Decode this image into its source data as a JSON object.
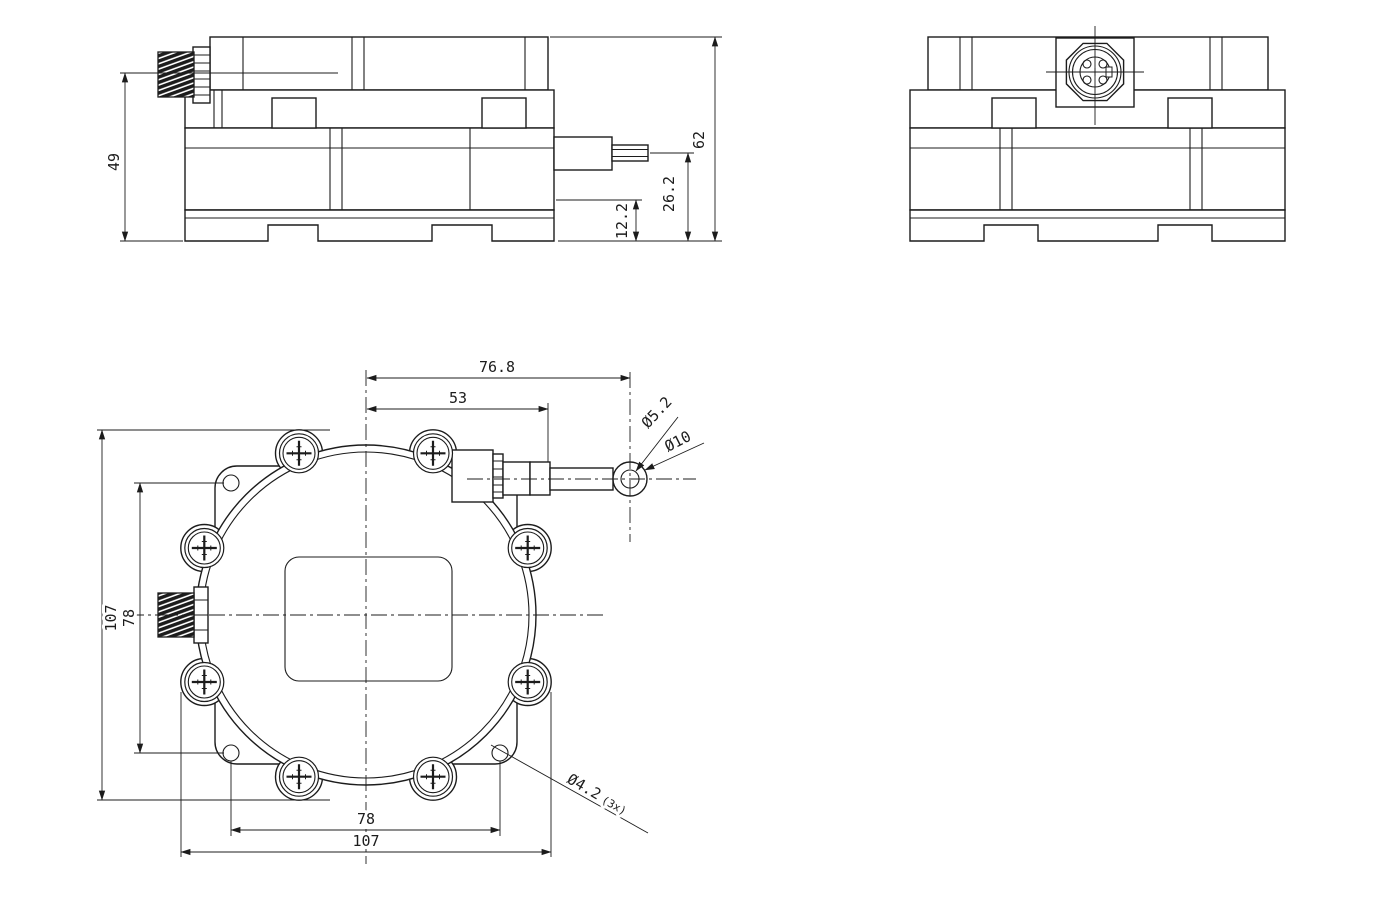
{
  "side_view": {
    "dim_connector_height": "49",
    "dim_total_height": "62",
    "dim_outlet_height": "26.2",
    "dim_step_height": "12.2"
  },
  "front_view": {
    "dim_center_to_eyelet": "76.8",
    "dim_center_to_outlet": "53",
    "dim_overall_height": "107",
    "dim_hole_spacing_vertical": "78",
    "dim_hole_spacing_horizontal": "78",
    "dim_overall_width": "107",
    "dim_eyelet_bore": "Ø5.2",
    "dim_eyelet_outer": "Ø10",
    "dim_mount_hole": "Ø4.2",
    "dim_mount_hole_count": "(3x)"
  },
  "colors": {
    "line": "#1c1c1c",
    "background": "#ffffff"
  }
}
